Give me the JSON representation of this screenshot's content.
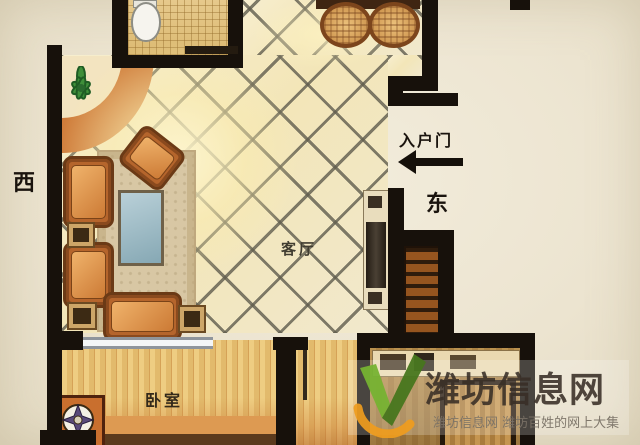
{
  "plan": {
    "type": "apartment-floor-plan",
    "compass": {
      "west": "西",
      "east": "东"
    },
    "entrance": {
      "label": "入户门",
      "arrow_icon": "entrance-arrow-icon",
      "arrow_direction": "left"
    },
    "rooms": {
      "living_room": {
        "label": "客厅",
        "floor": "diagonal-tile"
      },
      "bedroom": {
        "label": "卧室",
        "floor": "wood-plank",
        "window": "top-wall-window"
      },
      "bathroom": {
        "floor": "mosaic-tile",
        "fixtures": [
          "toilet"
        ]
      },
      "kitchen": {
        "floor": "wood",
        "fixtures": [
          "counter",
          "appliances",
          "table"
        ]
      }
    },
    "furniture": [
      "dining-table",
      "two-stools",
      "rug",
      "coffee-table",
      "armchair",
      "armchair",
      "angled-armchair",
      "loveseat",
      "side-tables",
      "tv-cabinet",
      "shoe-cabinet",
      "bed",
      "compass-nightstand",
      "potted-plant"
    ]
  },
  "watermark": {
    "brand": "潍坊信息网",
    "tagline": "潍坊信息网 潍坊百姓的网上大集",
    "logo_icon": "v-check-logo-icon",
    "colors": {
      "brand_text": "#382e26",
      "tagline_text": "#7a7266",
      "logo_green": "#76b232",
      "logo_green_dark": "#47761e",
      "logo_orange": "#ef9c1d"
    }
  },
  "palette": {
    "background": "#ece4d0",
    "wall": "#17110b",
    "tile_line": "#605d4e",
    "floor_glow": "#fdf5ce",
    "wood_light": "#eecd82",
    "accent_orange": "#cf7c3a",
    "window_gray": "#8f959c"
  }
}
